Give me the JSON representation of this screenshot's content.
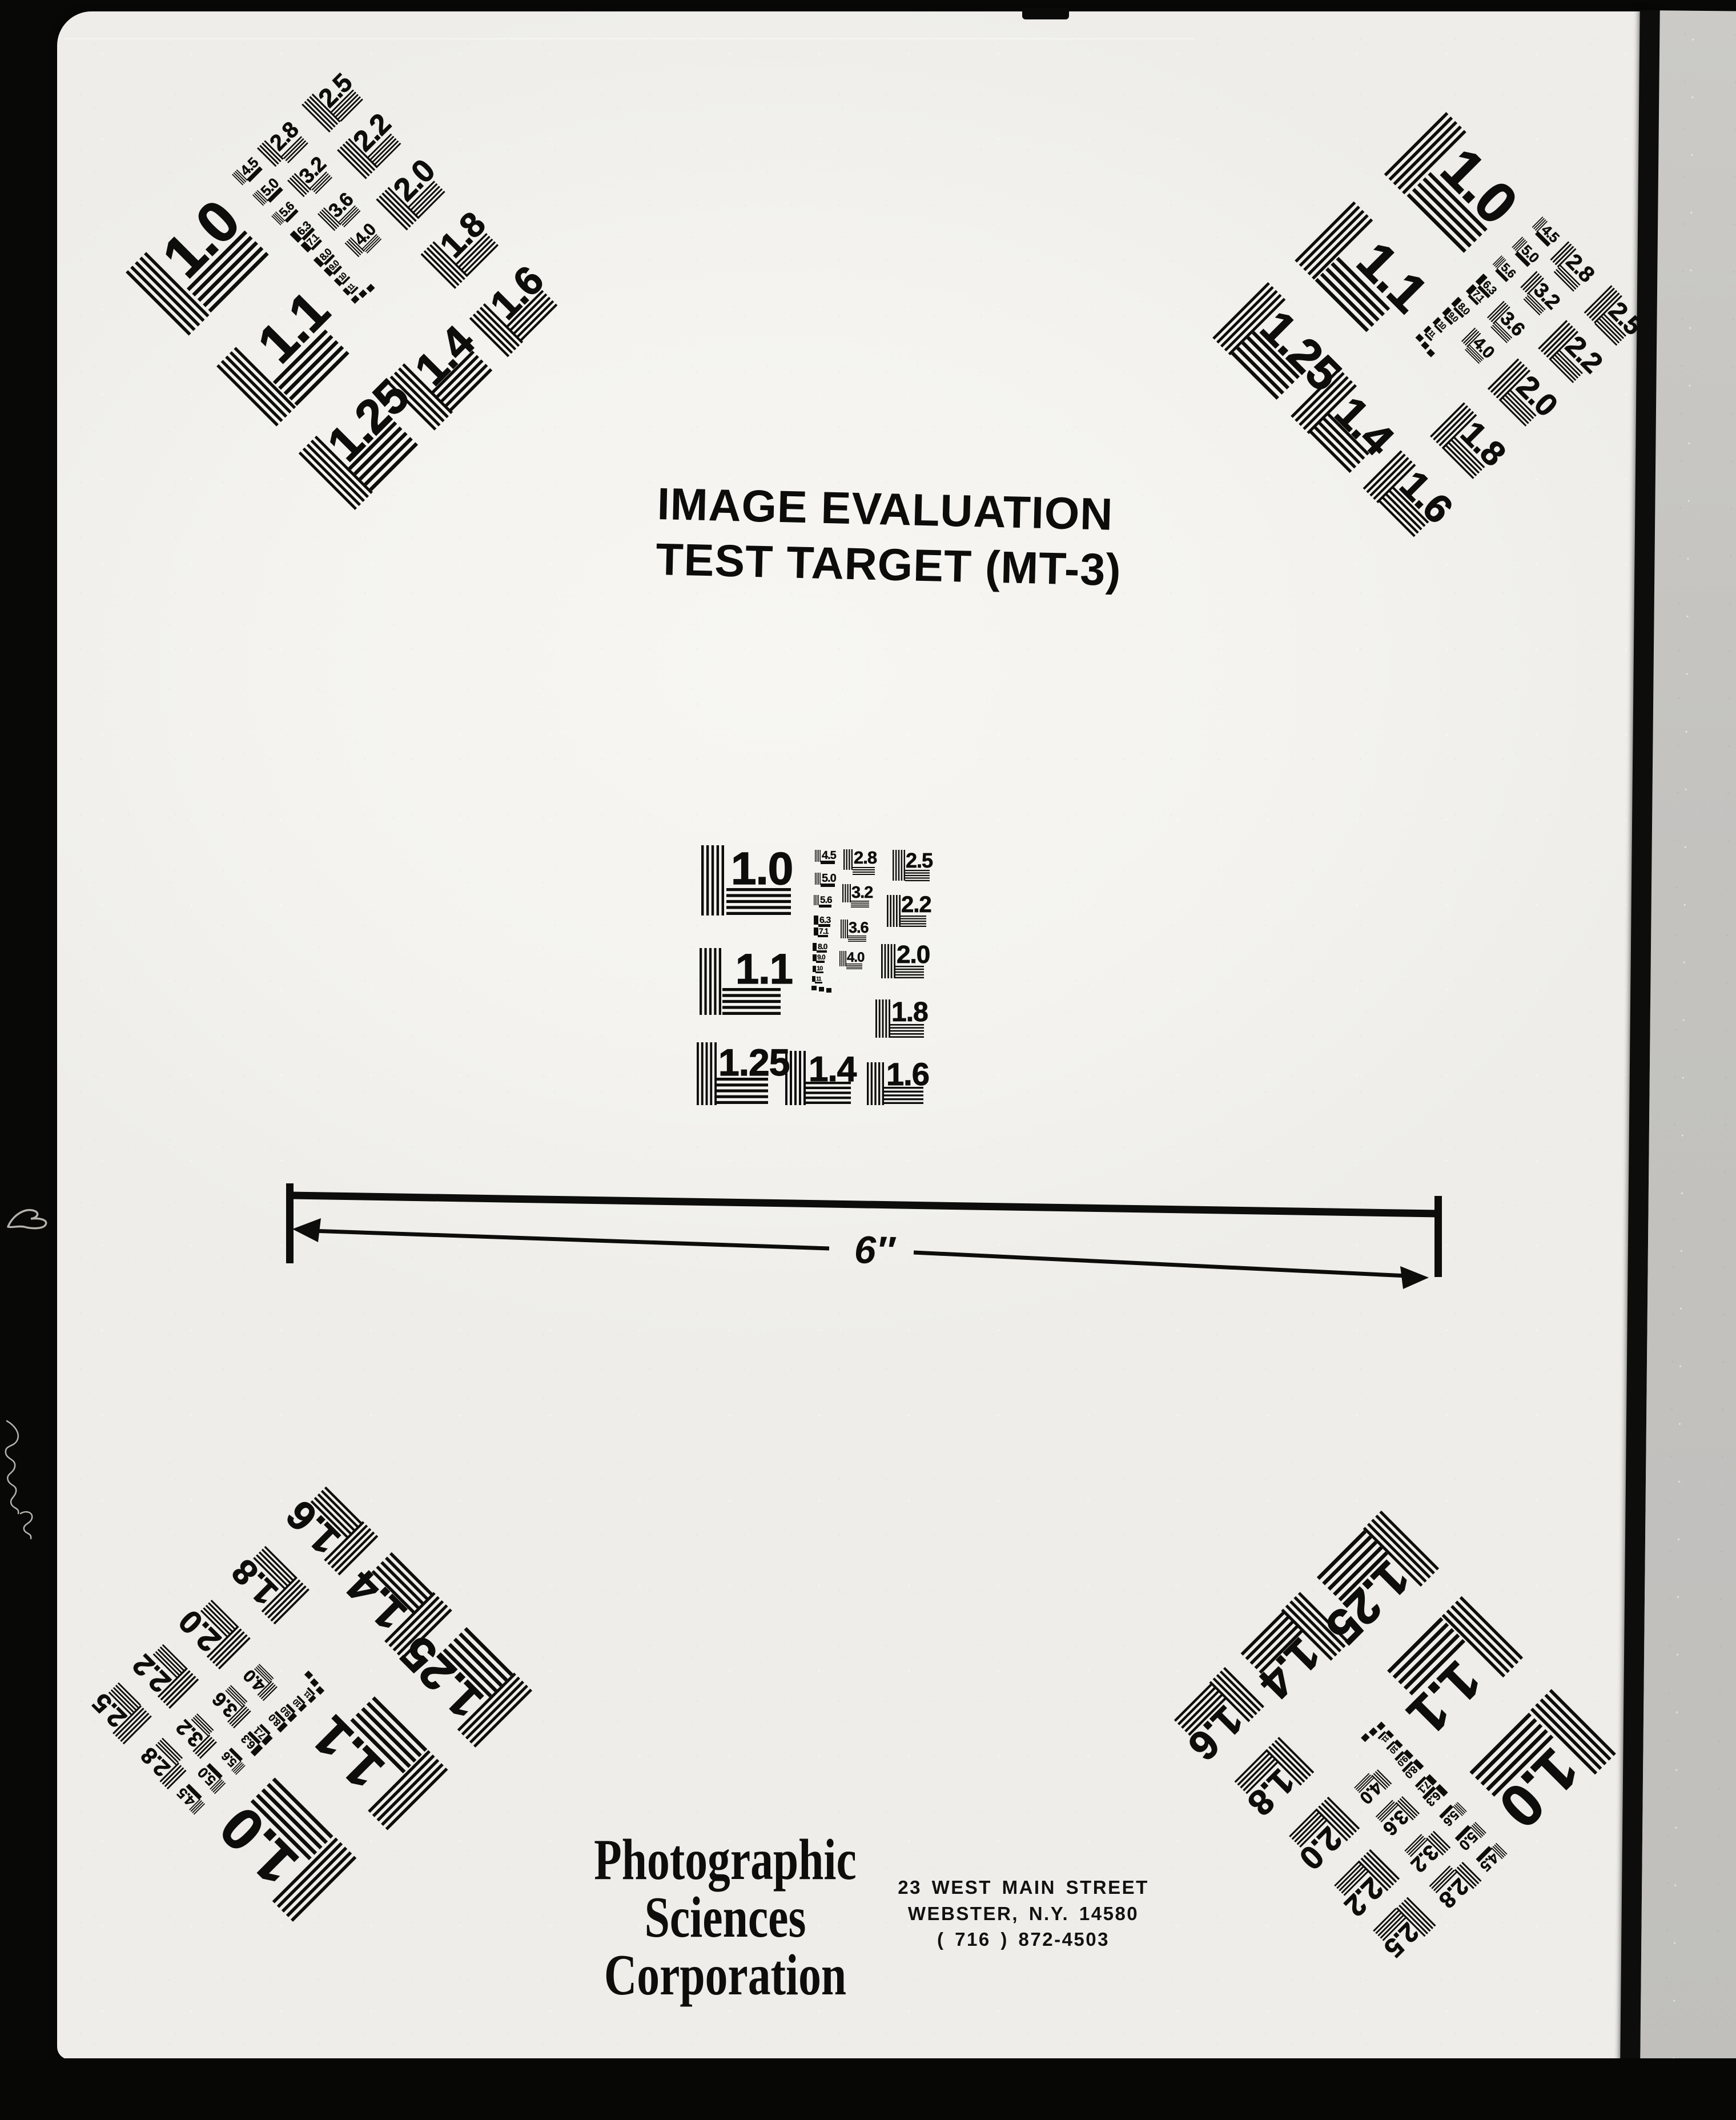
{
  "title": {
    "line1": "IMAGE EVALUATION",
    "line2": "TEST TARGET (MT-3)"
  },
  "dimension": {
    "label": "6″"
  },
  "test_pattern": {
    "labels": [
      "1.0",
      "1.1",
      "1.25",
      "1.4",
      "1.6",
      "1.8",
      "2.0",
      "2.2",
      "2.5",
      "2.8",
      "3.2",
      "3.6",
      "4.0",
      "4.5",
      "5.0",
      "5.6",
      "6.3",
      "7.1",
      "8.0",
      "9.0",
      "10",
      "11"
    ],
    "instances": [
      "center",
      "top-left",
      "top-right",
      "bottom-left",
      "bottom-right"
    ]
  },
  "footer": {
    "company_lines": [
      "Photographic",
      "Sciences",
      "Corporation"
    ],
    "address_lines": [
      "23 WEST MAIN STREET",
      "WEBSTER, N.Y. 14580",
      "( 716 ) 872-4503"
    ]
  },
  "colors": {
    "ink": "#0d0d0b",
    "paper": "#f5f4f0",
    "film_black": "#070707",
    "film_gray": "#c3c2bf"
  }
}
